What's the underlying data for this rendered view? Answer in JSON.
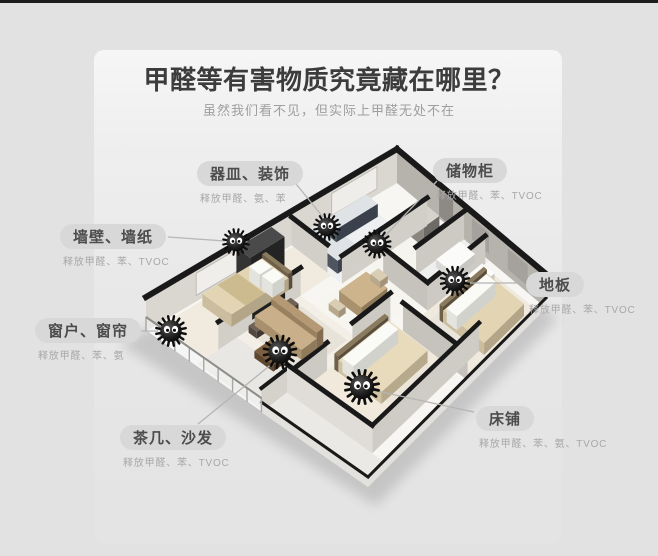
{
  "header": {
    "title": "甲醛等有害物质究竟藏在哪里？",
    "subtitle": "虽然我们看不见，但实际上甲醛无处不在"
  },
  "callouts": [
    {
      "id": "dishes-decor",
      "title": "器皿、装饰",
      "sub": "释放甲醛、氨、苯",
      "pill": {
        "x": 197,
        "y": 161
      },
      "line": {
        "x1": 292,
        "y1": 179,
        "x2": 323,
        "y2": 217
      },
      "target": {
        "x": 327,
        "y": 227
      }
    },
    {
      "id": "storage-cabinet",
      "title": "储物柜",
      "sub": "释放甲醛、苯、TVOC",
      "pill": {
        "x": 433,
        "y": 158
      },
      "line": {
        "x1": 437,
        "y1": 181,
        "x2": 383,
        "y2": 238
      },
      "target": {
        "x": 377,
        "y": 244
      }
    },
    {
      "id": "wall-wallpaper",
      "title": "墙壁、墙纸",
      "sub": "释放甲醛、苯、TVOC",
      "pill": {
        "x": 60,
        "y": 224
      },
      "line": {
        "x1": 168,
        "y1": 237,
        "x2": 225,
        "y2": 241
      },
      "target": {
        "x": 236,
        "y": 242
      }
    },
    {
      "id": "floor",
      "title": "地板",
      "sub": "释放甲醛、苯、TVOC",
      "pill": {
        "x": 526,
        "y": 272
      },
      "line": {
        "x1": 524,
        "y1": 283,
        "x2": 470,
        "y2": 283
      },
      "target": {
        "x": 455,
        "y": 281
      }
    },
    {
      "id": "window-curtain",
      "title": "窗户、窗帘",
      "sub": "释放甲醛、苯、氨",
      "pill": {
        "x": 35,
        "y": 318
      },
      "line": {
        "x1": 141,
        "y1": 331,
        "x2": 158,
        "y2": 331
      },
      "target": {
        "x": 171,
        "y": 331
      }
    },
    {
      "id": "tea-table-sofa",
      "title": "茶几、沙发",
      "sub": "释放甲醛、苯、TVOC",
      "pill": {
        "x": 120,
        "y": 425
      },
      "line": {
        "x1": 198,
        "y1": 424,
        "x2": 273,
        "y2": 363
      },
      "target": {
        "x": 280,
        "y": 352
      }
    },
    {
      "id": "bed",
      "title": "床铺",
      "sub": "释放甲醛、苯、氨、TVOC",
      "pill": {
        "x": 476,
        "y": 406
      },
      "line": {
        "x1": 474,
        "y1": 412,
        "x2": 377,
        "y2": 391
      },
      "target": {
        "x": 362,
        "y": 387
      }
    }
  ],
  "hotspots": [
    {
      "id": "monster-dishes",
      "x": 327,
      "y": 227,
      "s": 1.0
    },
    {
      "id": "monster-wall",
      "x": 236,
      "y": 242,
      "s": 1.0
    },
    {
      "id": "monster-storage",
      "x": 377,
      "y": 244,
      "s": 1.05
    },
    {
      "id": "monster-floor",
      "x": 455,
      "y": 281,
      "s": 1.1
    },
    {
      "id": "monster-window",
      "x": 171,
      "y": 331,
      "s": 1.15
    },
    {
      "id": "monster-sofa",
      "x": 280,
      "y": 352,
      "s": 1.25
    },
    {
      "id": "monster-bed",
      "x": 362,
      "y": 387,
      "s": 1.3
    }
  ],
  "colors": {
    "background": "#e2e2e2",
    "card": "#f0f0f0",
    "title": "#3c3c3c",
    "subtitle": "#9e9e9e",
    "pill_bg": "#d8d8d8",
    "pill_text": "#4c4c4c",
    "sub_text": "#a8a8a8",
    "connector": "#b5b5b5",
    "wall_cap": "#191919",
    "monster": "#111111"
  }
}
